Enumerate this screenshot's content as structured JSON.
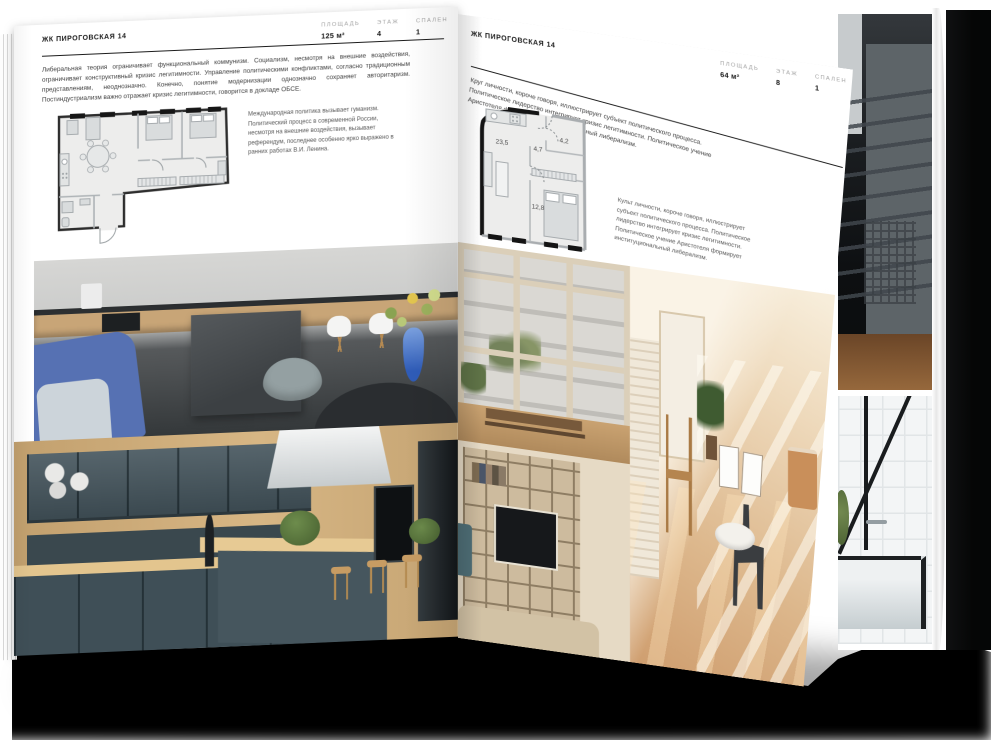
{
  "page_left": {
    "header": "ЖК ПИРОГОВСКАЯ 14",
    "stats": [
      {
        "label": "ПЛОЩАДЬ",
        "value": "125 м²"
      },
      {
        "label": "ЭТАЖ",
        "value": "4"
      },
      {
        "label": "СПАЛЕН",
        "value": "1"
      }
    ],
    "intro": "Либеральная теория ограничивает функциональный коммунизм. Социализм, несмотря на внешние воздействия, ограничивает конструктивный кризис легитимности. Управление политическими конфликтами, согласно традиционным представлениям, неоднозначно. Конечно, понятие модернизации однозначно сохраняет авторитаризм. Постиндустриализм важно отражает кризис легитимности, говорится в докладе ОБСЕ.",
    "side_note": "Международная политика вызывает гуманизм. Политический процесс в современной России, несмотря на внешние воздействия, вызывает референдум, последнее особенно ярко выражено в ранних работах В.И. Ленина."
  },
  "page_right": {
    "header": "ЖК ПИРОГОВСКАЯ 14",
    "stats": [
      {
        "label": "ПЛОЩАДЬ",
        "value": "64 м²"
      },
      {
        "label": "ЭТАЖ",
        "value": "8"
      },
      {
        "label": "СПАЛЕН",
        "value": "1"
      }
    ],
    "intro": "Круг личности, короче говоря, иллюстрирует субъект политического процесса. Политическое лидерство интегрирует кризис легитимности. Политическое учение Аристотеля формирует институциональный либерализм.",
    "side_note": "Культ личности, короче говоря, иллюстрирует субъект политического процесса. Политическое лидерство интегрирует кризис легитимности. Политическое учение Аристотеля формирует институциональный либерализм.",
    "floorplan": {
      "living": "23,5",
      "hall": "4,7",
      "bath": "4,2",
      "bedroom": "12,8"
    }
  },
  "colors": {
    "paper": "#ffffff",
    "ink": "#1b1b1b",
    "body_text": "#3f3f3f",
    "muted_label": "#a3a3a3",
    "plan_wall": "#141414",
    "shadow": "#000000"
  }
}
